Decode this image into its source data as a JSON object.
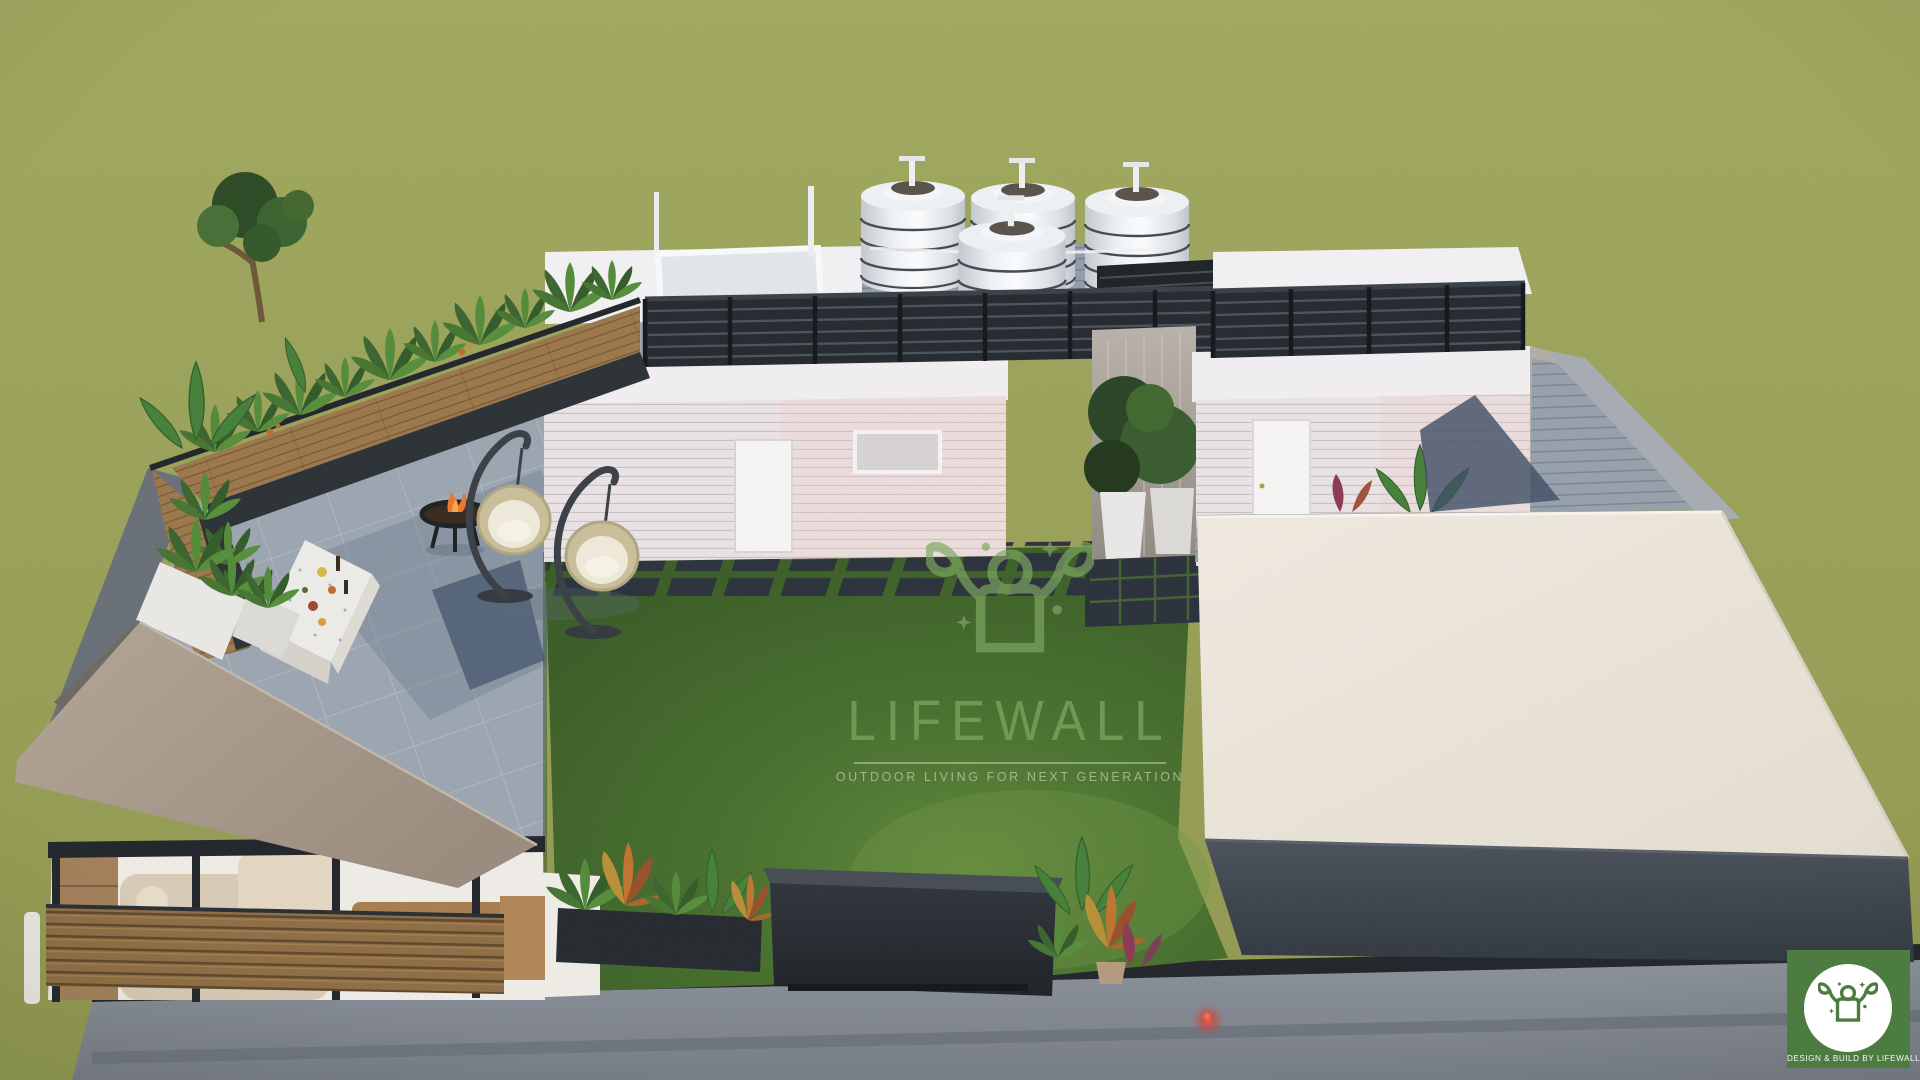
{
  "watermark": {
    "brand": "LIFEWALL",
    "tagline": "OUTDOOR LIVING FOR NEXT GENERATION",
    "icon": "lifewall-sprout-person-icon"
  },
  "badge": {
    "label": "DESIGN & BUILD BY LIFEWALL",
    "icon": "lifewall-sprout-person-icon"
  },
  "scene": {
    "type": "3d-aerial-render",
    "subject": "rooftop terrace landscape design",
    "elements": [
      "water-tanks",
      "penthouse-room",
      "roof-railing",
      "terrace-planters",
      "fire-pit",
      "hanging-chairs",
      "outdoor-bar-counter",
      "lounge-pergola",
      "lawn",
      "stepping-stones",
      "privacy-screen",
      "flat-roof-pavilion",
      "garden-plants",
      "parapet-wall"
    ]
  },
  "palette": {
    "ground": "#9aa15b",
    "ground_dark": "#8e9650",
    "lawn": "#47702c",
    "lawn_light": "#6b9240",
    "tile": "#9ba6b1",
    "concrete": "#828a93",
    "parapet": "#23272c",
    "white_roof": "#f1f0f2",
    "wall_white": "#e9e3e5",
    "railing": "#262b31",
    "wood": "#9c784c",
    "taupe_roof": "#a89a8c",
    "cream_roof": "#ebe5da",
    "fascia_dark": "#3f464f",
    "marble": "#efece7",
    "sofa": "#d9cbb6",
    "plant_dark": "#2f4a28",
    "plant_mid": "#45702f",
    "croton_orange": "#c07a30",
    "fire_orange": "#e8772c",
    "watermark_green": "#7fa862",
    "badge_green": "#4d7c40"
  }
}
